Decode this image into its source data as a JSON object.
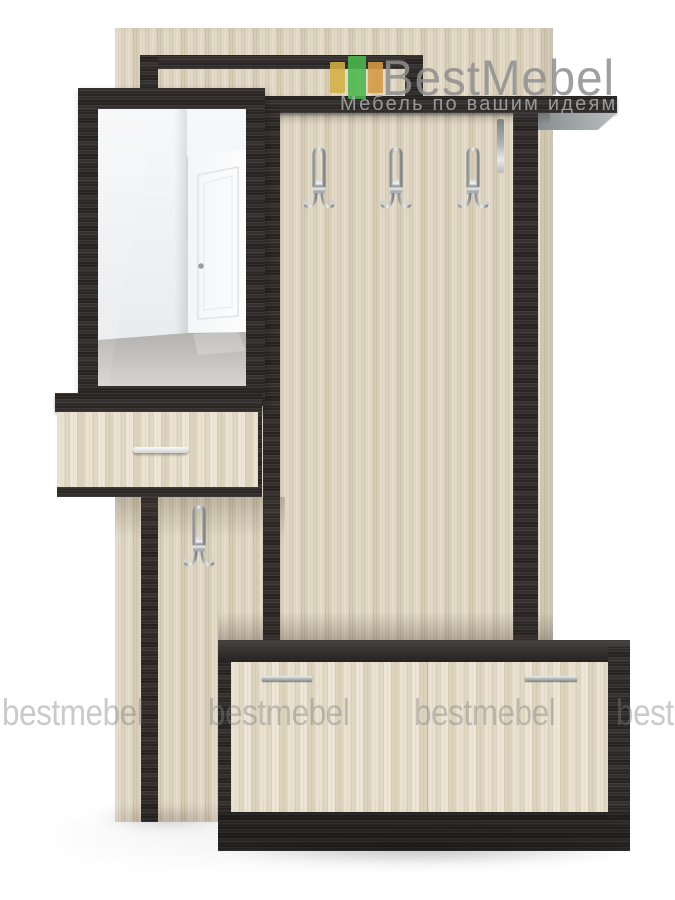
{
  "logo": {
    "brand": "BestMebel",
    "tagline": "Мебель по вашим идеям"
  },
  "watermarks": [
    "bestmebel",
    "bestmebel",
    "bestmebel",
    "bestmebel"
  ],
  "colors": {
    "logo_bar_yellow": "#d4af43",
    "logo_bar_green": "#4ab84f",
    "logo_bar_orange": "#d69a45",
    "logo_text": "#8f8f8f",
    "tagline_text": "#a6a9a9",
    "watermark_text": "rgba(128,128,128,0.42)",
    "wood_light": "#e0d7c4",
    "wood_dark": "#2d2a28",
    "chrome": "#c2c5c6"
  }
}
